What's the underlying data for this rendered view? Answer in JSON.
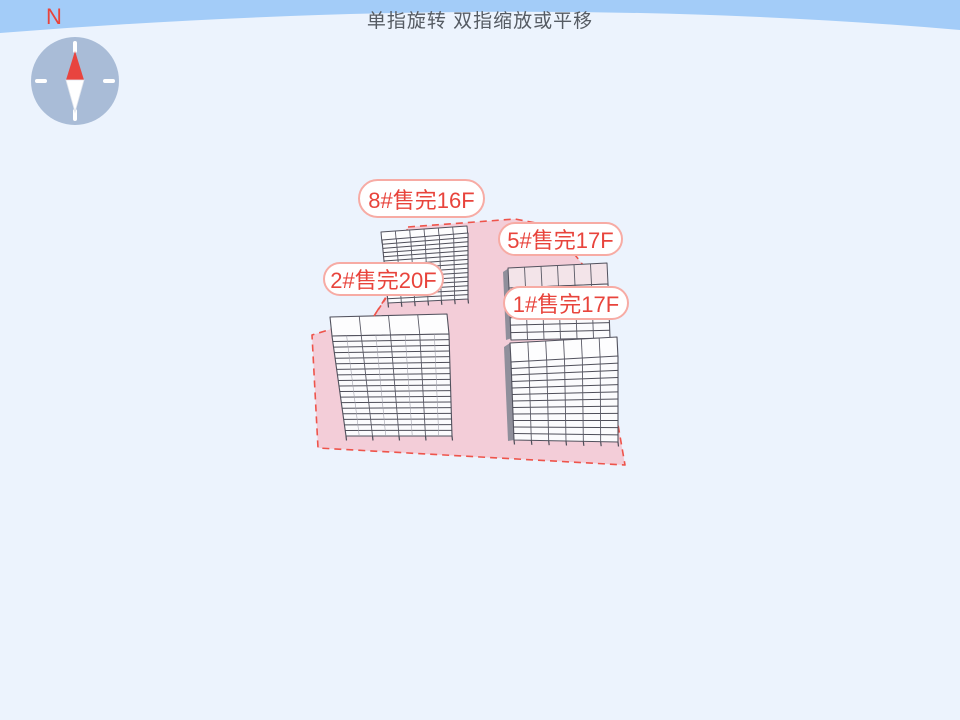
{
  "title": {
    "gesture_hint": "单指旋转 双指缩放或平移"
  },
  "compass": {
    "north_label": "N"
  },
  "site": {
    "buildings": [
      {
        "id": "8#",
        "status": "售完",
        "floors": "16F",
        "label": "8#售完16F"
      },
      {
        "id": "5#",
        "status": "售完",
        "floors": "17F",
        "label": "5#售完17F"
      },
      {
        "id": "2#",
        "status": "售完",
        "floors": "20F",
        "label": "2#售完20F"
      },
      {
        "id": "1#",
        "status": "售完",
        "floors": "17F",
        "label": "1#售完17F"
      }
    ]
  },
  "colors": {
    "sky": "#a3ccf8",
    "ground": "#ecf3fd",
    "parcel_fill": "#f3cdd8",
    "parcel_border": "#ee544b",
    "label_text": "#e8443c",
    "label_border": "#f7aba4",
    "compass_disc": "#a9bcd7",
    "needle_north": "#e8443f"
  }
}
